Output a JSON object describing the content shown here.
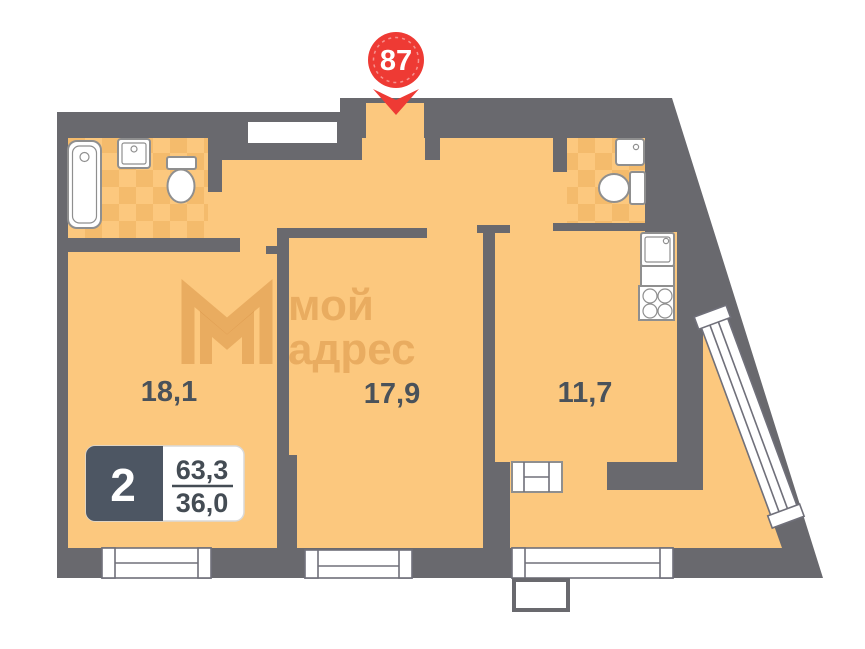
{
  "pin": {
    "number": "87"
  },
  "watermark": {
    "logo_line1": "мой",
    "logo_line2": "адрес"
  },
  "rooms": {
    "room1": {
      "area": "18,1"
    },
    "room2": {
      "area": "17,9"
    },
    "room3": {
      "area": "11,7"
    }
  },
  "info_box": {
    "rooms_count": "2",
    "total_area": "63,3",
    "living_area": "36,0"
  },
  "colors": {
    "floor": "#fcc87e",
    "wall": "#69696e",
    "tile_accent": "#eeb261",
    "pin_red": "#ee3a34",
    "info_dark": "#4d5663",
    "label_text": "#4a525a"
  }
}
